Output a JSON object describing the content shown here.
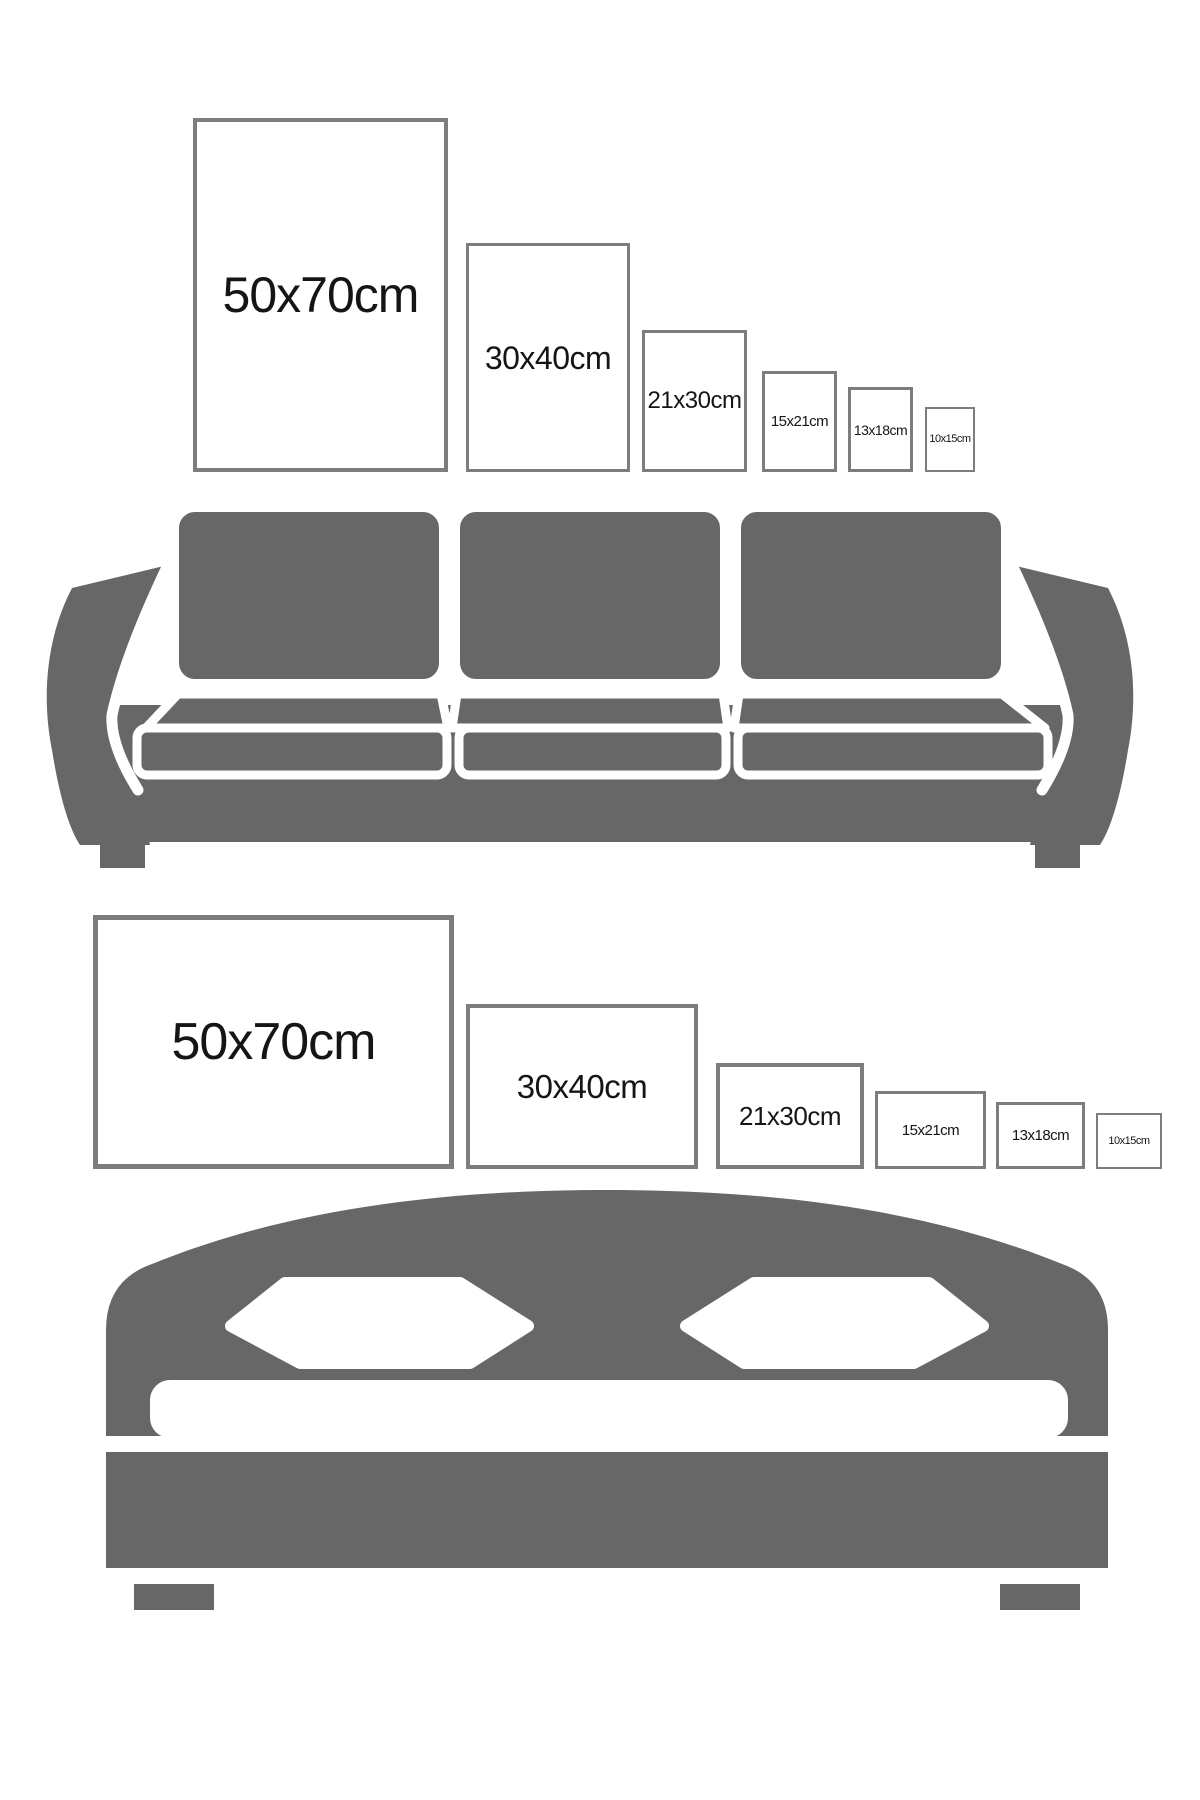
{
  "page_title": "Frame Size Guide",
  "colors": {
    "background": "#ffffff",
    "furniture_gray": "#676767",
    "frame_border": "#7d7d7d",
    "label_text": "#151515",
    "cushion_gap_white": "#ffffff"
  },
  "sofa_section": {
    "furniture": "sofa",
    "frames": [
      {
        "label": "50x70cm",
        "orientation": "portrait"
      },
      {
        "label": "30x40cm",
        "orientation": "portrait"
      },
      {
        "label": "21x30cm",
        "orientation": "portrait"
      },
      {
        "label": "15x21cm",
        "orientation": "portrait"
      },
      {
        "label": "13x18cm",
        "orientation": "portrait"
      },
      {
        "label": "10x15cm",
        "orientation": "portrait"
      }
    ]
  },
  "bed_section": {
    "furniture": "bed",
    "frames": [
      {
        "label": "50x70cm",
        "orientation": "landscape"
      },
      {
        "label": "30x40cm",
        "orientation": "landscape"
      },
      {
        "label": "21x30cm",
        "orientation": "landscape"
      },
      {
        "label": "15x21cm",
        "orientation": "landscape"
      },
      {
        "label": "13x18cm",
        "orientation": "landscape"
      },
      {
        "label": "10x15cm",
        "orientation": "landscape"
      }
    ]
  }
}
